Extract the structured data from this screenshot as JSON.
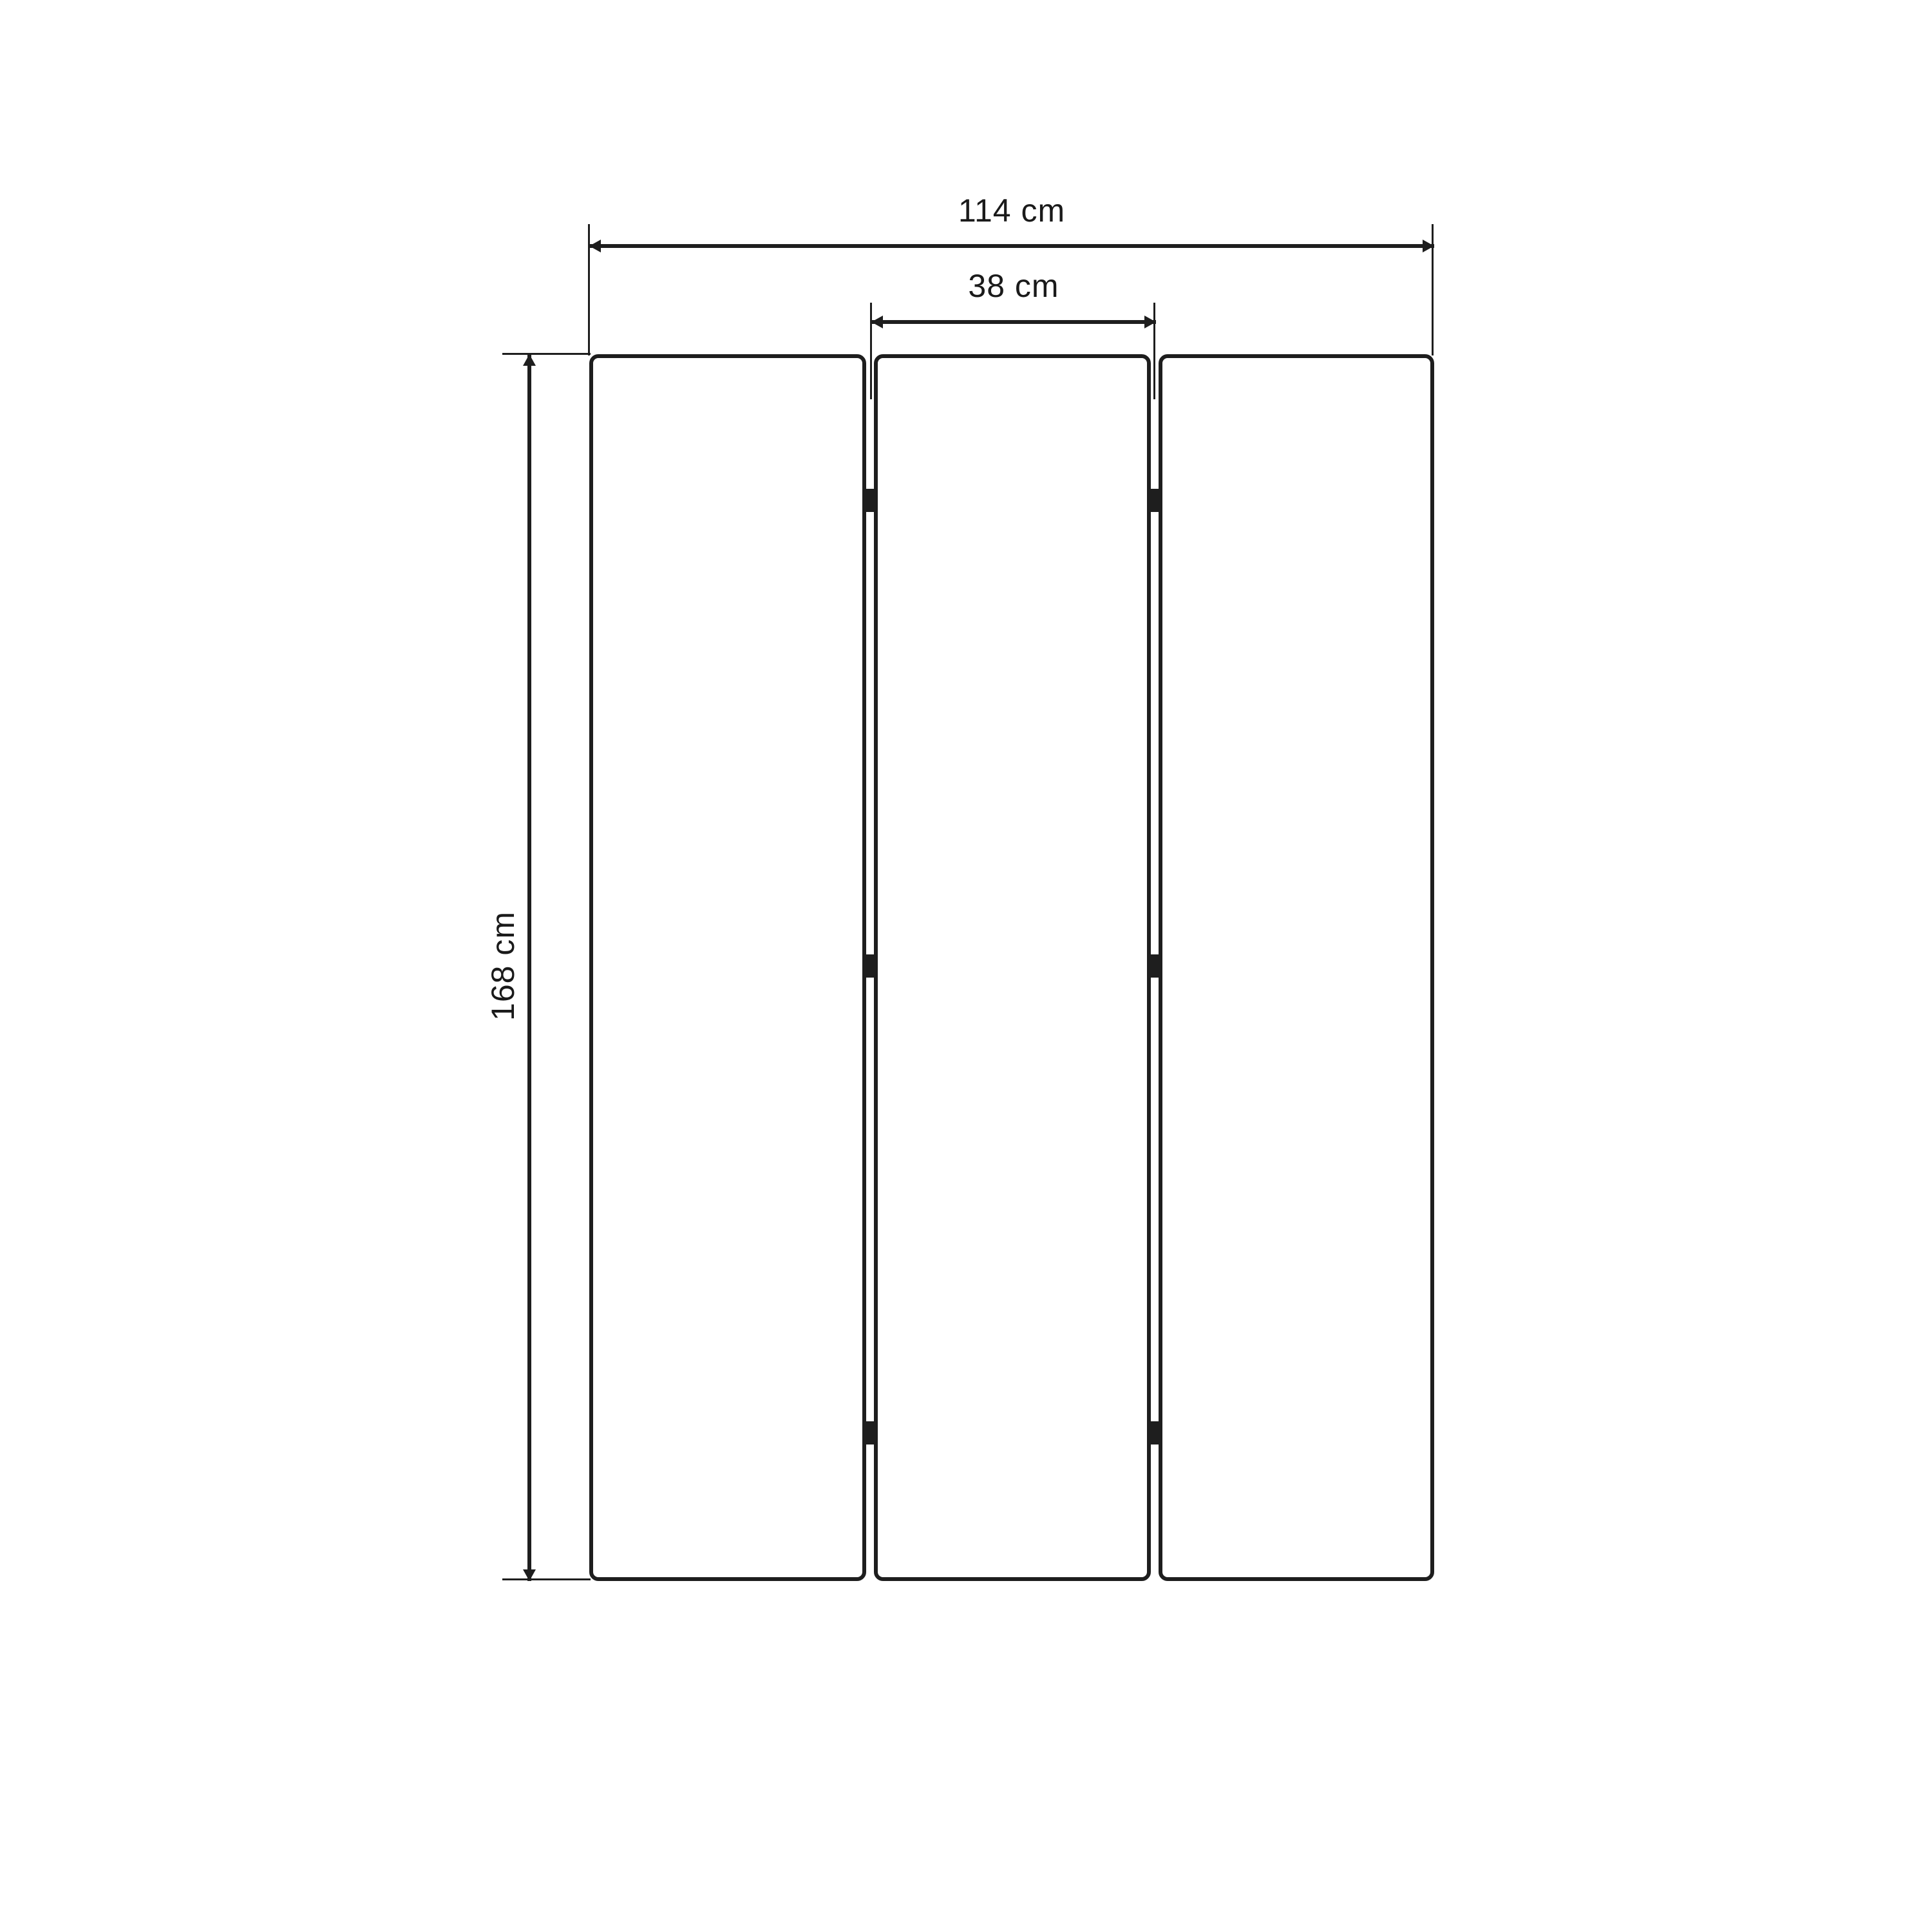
{
  "diagram": {
    "dimensions": {
      "total_width": "114 cm",
      "panel_width": "38 cm",
      "height": "168 cm"
    },
    "panel_count": 3,
    "hinges_per_gap": 3,
    "colors": {
      "line": "#1e1e1e",
      "text": "#1a1a1a",
      "background": "#ffffff"
    }
  }
}
